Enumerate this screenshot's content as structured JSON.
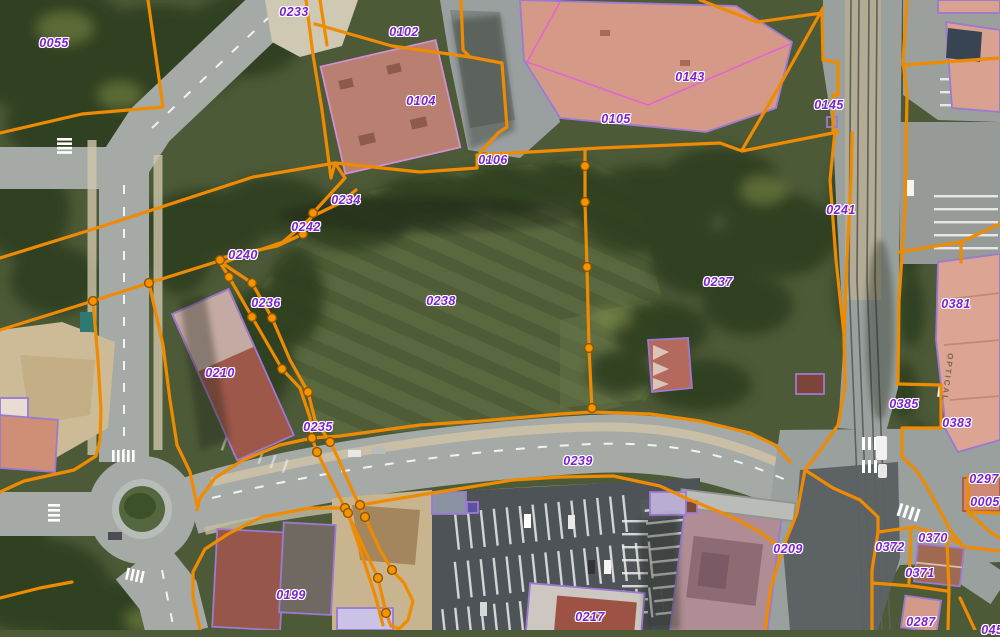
{
  "app": {
    "description": "Cadastral parcel web-map over aerial orthophoto"
  },
  "colors": {
    "line-orange": "#ee8b00",
    "dot-orange": "#f59300",
    "dot-ring": "#8f5400",
    "label-purple": "#7d1fd3",
    "building-violet": "#9c79d2",
    "division-magenta": "#e564d2"
  },
  "map": {
    "roof_text": {
      "text": "OPTICAL"
    },
    "parcel_labels": [
      {
        "id": "0055",
        "x": 54,
        "y": 43
      },
      {
        "id": "0233",
        "x": 294,
        "y": 12
      },
      {
        "id": "0102",
        "x": 404,
        "y": 32
      },
      {
        "id": "0104",
        "x": 421,
        "y": 101
      },
      {
        "id": "0143",
        "x": 690,
        "y": 77
      },
      {
        "id": "0105",
        "x": 616,
        "y": 119
      },
      {
        "id": "0145",
        "x": 829,
        "y": 105
      },
      {
        "id": "0106",
        "x": 493,
        "y": 160
      },
      {
        "id": "0234",
        "x": 346,
        "y": 200
      },
      {
        "id": "0242",
        "x": 306,
        "y": 227
      },
      {
        "id": "0241",
        "x": 841,
        "y": 210
      },
      {
        "id": "0240",
        "x": 243,
        "y": 255
      },
      {
        "id": "0236",
        "x": 266,
        "y": 303
      },
      {
        "id": "0237",
        "x": 718,
        "y": 282
      },
      {
        "id": "0238",
        "x": 441,
        "y": 301
      },
      {
        "id": "0381",
        "x": 956,
        "y": 304
      },
      {
        "id": "0210",
        "x": 220,
        "y": 373
      },
      {
        "id": "0385",
        "x": 904,
        "y": 404
      },
      {
        "id": "0383",
        "x": 957,
        "y": 423
      },
      {
        "id": "0235",
        "x": 318,
        "y": 427
      },
      {
        "id": "0239",
        "x": 578,
        "y": 461
      },
      {
        "id": "0297",
        "x": 984,
        "y": 479
      },
      {
        "id": "0005",
        "x": 985,
        "y": 502
      },
      {
        "id": "0370",
        "x": 933,
        "y": 538
      },
      {
        "id": "0372",
        "x": 890,
        "y": 547
      },
      {
        "id": "0209",
        "x": 788,
        "y": 549
      },
      {
        "id": "0371",
        "x": 920,
        "y": 573
      },
      {
        "id": "0199",
        "x": 291,
        "y": 595
      },
      {
        "id": "0217",
        "x": 590,
        "y": 617
      },
      {
        "id": "0287",
        "x": 921,
        "y": 622
      },
      {
        "id": "0457",
        "x": 996,
        "y": 630
      }
    ]
  }
}
